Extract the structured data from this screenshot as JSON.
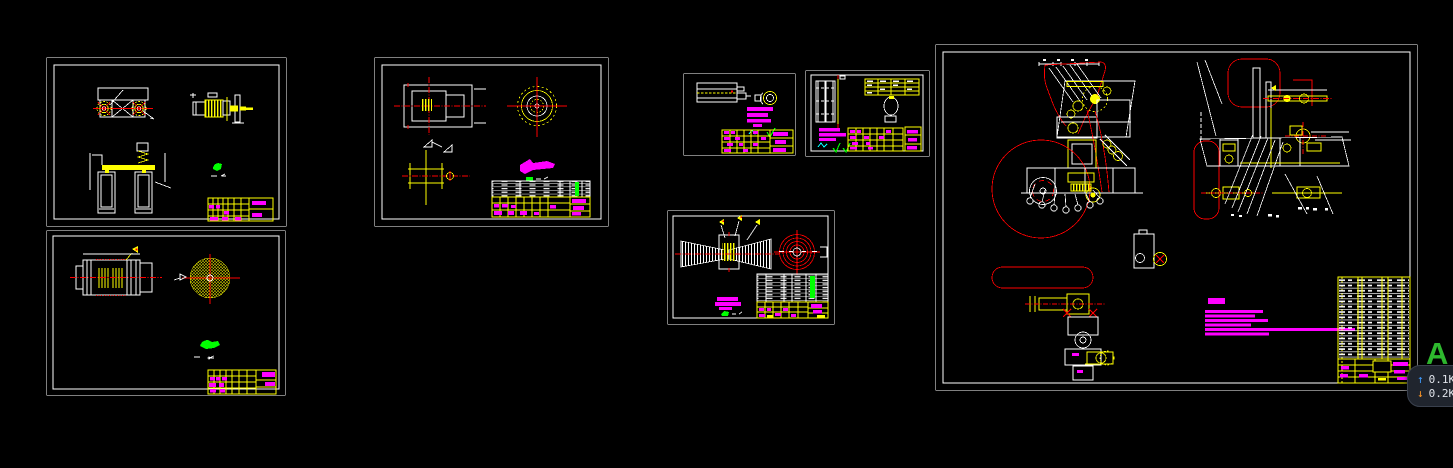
{
  "palette": {
    "canvas_bg": "#000000",
    "line_white": "#ffffff",
    "line_yellow": "#ffff00",
    "line_red": "#ff0000",
    "annotation_magenta": "#ff00ff",
    "annotation_green": "#00ff00",
    "annotation_cyan": "#00ffff",
    "watermark_green": "#2eb82e",
    "badge_bg": "#20252e",
    "badge_border": "#3a414e",
    "badge_text": "#dfe3ea",
    "badge_up": "#3f9bff",
    "badge_down": "#ff9726"
  },
  "overlay_badge": {
    "up_arrow": "↑",
    "up_value": "0.1K",
    "down_arrow": "↓",
    "down_value": "0.2K"
  },
  "watermark": {
    "letter": "A"
  }
}
